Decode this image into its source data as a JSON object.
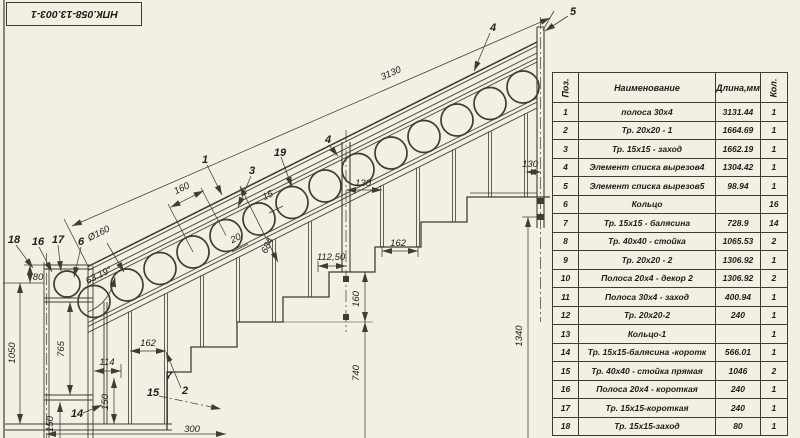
{
  "title_block": {
    "doc_number": "НПК.058-13.003-1"
  },
  "table": {
    "headers": {
      "pos": "Поз.",
      "name": "Наименование",
      "length": "Длина,мм",
      "qty": "Кол."
    },
    "rows": [
      {
        "pos": "1",
        "name": "полоса 30х4",
        "length": "3131.44",
        "qty": "1"
      },
      {
        "pos": "2",
        "name": "Тр. 20х20 - 1",
        "length": "1664.69",
        "qty": "1"
      },
      {
        "pos": "3",
        "name": "Тр. 15х15 - заход",
        "length": "1662.19",
        "qty": "1"
      },
      {
        "pos": "4",
        "name": "Элемент списка вырезов4",
        "length": "1304.42",
        "qty": "1"
      },
      {
        "pos": "5",
        "name": "Элемент списка вырезов5",
        "length": "98.94",
        "qty": "1"
      },
      {
        "pos": "6",
        "name": "Кольцо",
        "length": "",
        "qty": "16"
      },
      {
        "pos": "7",
        "name": "Тр. 15х15 - балясина",
        "length": "728.9",
        "qty": "14"
      },
      {
        "pos": "8",
        "name": "Тр. 40х40 - стойка",
        "length": "1065.53",
        "qty": "2"
      },
      {
        "pos": "9",
        "name": "Тр. 20х20 - 2",
        "length": "1306.92",
        "qty": "1"
      },
      {
        "pos": "10",
        "name": "Полоса 20х4 - декор 2",
        "length": "1306.92",
        "qty": "2"
      },
      {
        "pos": "11",
        "name": "Полоса 30х4 - заход",
        "length": "400.94",
        "qty": "1"
      },
      {
        "pos": "12",
        "name": "Тр. 20х20-2",
        "length": "240",
        "qty": "1"
      },
      {
        "pos": "13",
        "name": "Кольцо-1",
        "length": "",
        "qty": "1"
      },
      {
        "pos": "14",
        "name": "Тр. 15х15-балясина -коротк",
        "length": "566.01",
        "qty": "1"
      },
      {
        "pos": "15",
        "name": "Тр. 40х40 - стойка прямая",
        "length": "1046",
        "qty": "2"
      },
      {
        "pos": "16",
        "name": "Полоса 20х4 - короткая",
        "length": "240",
        "qty": "1"
      },
      {
        "pos": "17",
        "name": "Тр. 15х15-короткая",
        "length": "240",
        "qty": "1"
      },
      {
        "pos": "18",
        "name": "Тр. 15х15-заход",
        "length": "80",
        "qty": "1"
      }
    ]
  },
  "dimensions": {
    "slope": "3130",
    "ringPitch": "160",
    "ringDia": "Ø160",
    "gap": "15",
    "d20": "20",
    "d684": "684",
    "angle": "63.19°",
    "b130a": "130",
    "b130b": "130",
    "b162a": "162",
    "b162b": "162",
    "b112": "112,50",
    "v160": "160",
    "v740": "740",
    "v1340": "1340",
    "v1050": "1050",
    "v80": "80",
    "v765": "765",
    "h114": "114",
    "v150a": "150",
    "v150b": "150",
    "h300": "300"
  },
  "callouts": {
    "p1": "1",
    "p2": "2",
    "p3": "3",
    "p4": "4",
    "p4b": "4",
    "p5": "5",
    "p6": "6",
    "p7": "7",
    "p14": "14",
    "p15": "15",
    "p16": "16",
    "p17": "17",
    "p18": "18",
    "p19": "19"
  },
  "colors": {
    "background": "#f2efe4",
    "line": "#3f3c32"
  }
}
